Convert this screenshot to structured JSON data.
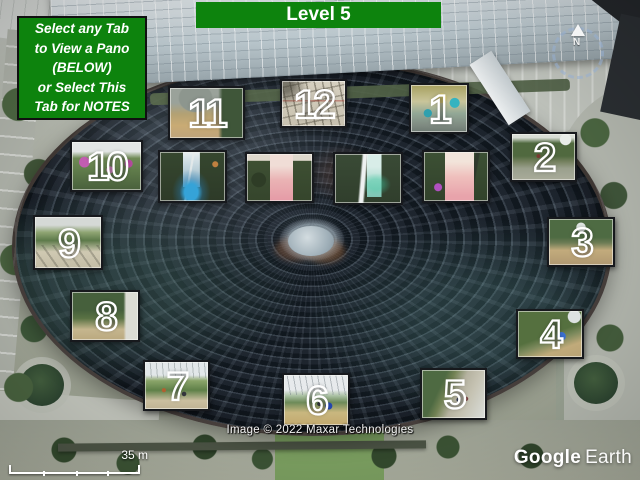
{
  "header": {
    "title": "Level 5"
  },
  "notes_tab": {
    "line1": "Select any Tab",
    "line2": "to View a Pano",
    "line3": "(BELOW)",
    "line4": "or Select This",
    "line5": "Tab for NOTES"
  },
  "tabs": [
    {
      "id": "1",
      "label": "1"
    },
    {
      "id": "2",
      "label": "2"
    },
    {
      "id": "3",
      "label": "3"
    },
    {
      "id": "4",
      "label": "4"
    },
    {
      "id": "5",
      "label": "5"
    },
    {
      "id": "6",
      "label": "6"
    },
    {
      "id": "7",
      "label": "7"
    },
    {
      "id": "8",
      "label": "8"
    },
    {
      "id": "9",
      "label": "9"
    },
    {
      "id": "10",
      "label": "10"
    },
    {
      "id": "11",
      "label": "11"
    },
    {
      "id": "12",
      "label": "12"
    },
    {
      "id": "vortex-preview-1",
      "label": ""
    },
    {
      "id": "vortex-preview-2",
      "label": ""
    },
    {
      "id": "vortex-preview-3",
      "label": ""
    },
    {
      "id": "vortex-preview-4",
      "label": ""
    }
  ],
  "map_overlay": {
    "attribution": "Image © 2022 Maxar Technologies",
    "scale_label": "35 m",
    "compass_label": "N",
    "logo": {
      "brand": "Google",
      "product": "Earth"
    }
  },
  "colors": {
    "accent_green": "#0d830d",
    "tab_border": "#17191d",
    "number_stroke": "#ffffff"
  }
}
